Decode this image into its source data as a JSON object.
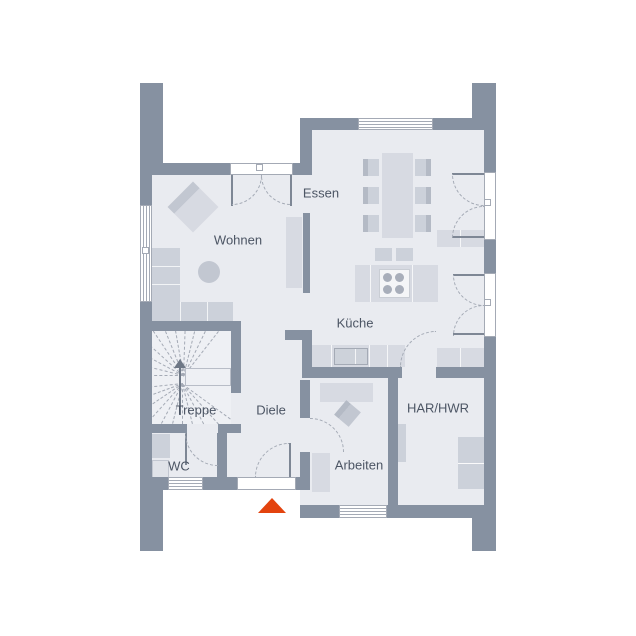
{
  "rooms": {
    "wohnen": {
      "label": "Wohnen"
    },
    "essen": {
      "label": "Essen"
    },
    "kueche": {
      "label": "Küche"
    },
    "treppe": {
      "label": "Treppe"
    },
    "diele": {
      "label": "Diele"
    },
    "wc": {
      "label": "WC"
    },
    "arbeiten": {
      "label": "Arbeiten"
    },
    "har_hwr": {
      "label": "HAR/HWR"
    }
  },
  "furniture": {
    "wohnen": [
      "corner-sofa",
      "armchair",
      "coffee-table",
      "sideboard"
    ],
    "essen": [
      "dining-table",
      "six-chairs",
      "sideboard"
    ],
    "kueche": [
      "island-with-cooktop",
      "two-bar-stools",
      "counter-with-sink",
      "counter"
    ],
    "treppe": [
      "winder-staircase",
      "direction-arrow"
    ],
    "wc": [
      "washbasin",
      "toilet"
    ],
    "arbeiten": [
      "desk",
      "office-chair",
      "cabinet"
    ],
    "har_hwr": [
      "appliance-washer",
      "appliance-dryer",
      "cabinet"
    ]
  },
  "entrance": {
    "icon": "entrance-triangle-marker"
  },
  "colors": {
    "wall": "#8691a1",
    "floor": "#e9ebf0",
    "floor_stairs": "#eef0f4",
    "furniture": "#d7dae2",
    "furniture_dark": "#c2c7d1",
    "fixture": "#ccd1da",
    "outline": "#a4aab5",
    "window_fill": "#ffffff",
    "door_panel": "#7e8795",
    "dash": "#a4aab5",
    "label_text": "#4c5564",
    "entrance_arrow": "#e3430e",
    "stairs_arrow": "#6e7886",
    "background": "#ffffff"
  }
}
